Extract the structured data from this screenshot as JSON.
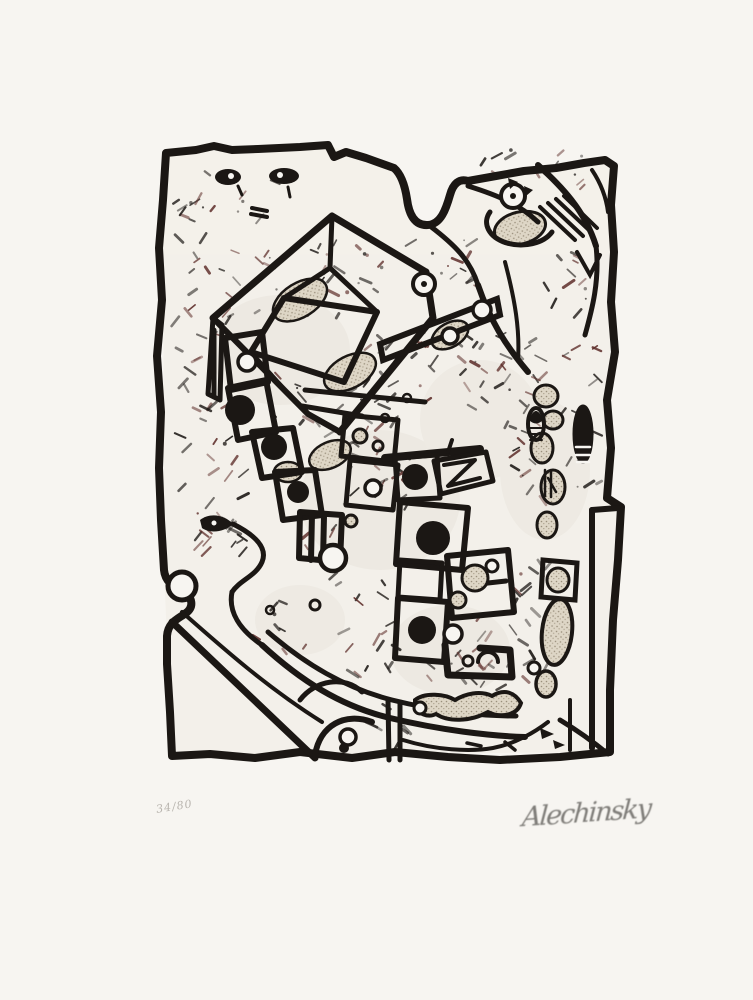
{
  "artwork": {
    "description": "abstract black ink lithograph print in the CoBrA style, irregular thick framed field filled with boxes, ladders of rectangles, black discs, serpentine bands, stippled totem forms and dense hatch marks",
    "edition": "34/80",
    "signature": "Alechinsky",
    "colors": {
      "paper": "#f7f5f1",
      "ink": "#1b1714",
      "stipple": "#ded6c6",
      "accent_hatch": "#5e2e2a",
      "pencil": "#8a8884"
    }
  }
}
